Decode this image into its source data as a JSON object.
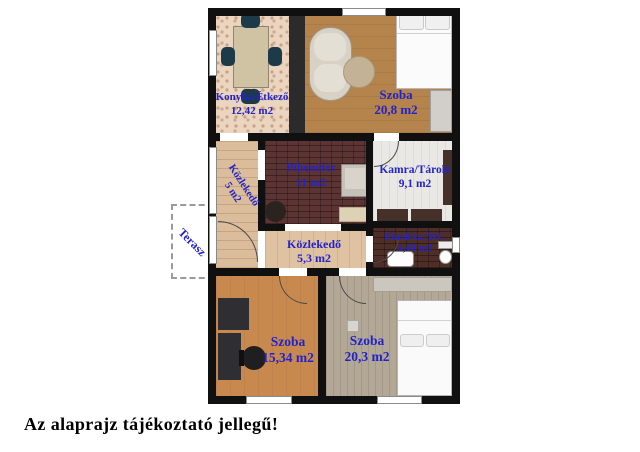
{
  "plan": {
    "rooms": [
      {
        "name": "Konyha/Étkező",
        "area": "12,42 m2"
      },
      {
        "name": "Szoba",
        "area": "20,8 m2"
      },
      {
        "name": "Közlekedő",
        "area": "5 m2"
      },
      {
        "name": "Pihenőtér",
        "area": "11 m2"
      },
      {
        "name": "Kamra/Tároló",
        "area": "9,1 m2"
      },
      {
        "name": "Közlekedő",
        "area": "5,3 m2"
      },
      {
        "name": "Fürdősz./WC",
        "area": "4,46 m2"
      },
      {
        "name": "Szoba",
        "area": "15,34 m2"
      },
      {
        "name": "Szoba",
        "area": "20,3 m2"
      }
    ],
    "terrace_label": "Terasz",
    "caption": "Az alaprajz tájékoztató jellegű!",
    "colors": {
      "label_blue": "#2323c8",
      "wall_black": "#101010",
      "kitchen_floor": "#e9d5c0",
      "bedroom_top_floor": "#b5834c",
      "hall_floor": "#dcbd9b",
      "lounge_floor": "#5d3434",
      "pantry_floor": "#eae8e4",
      "bath_floor": "#4f2e27",
      "bedroom_left_floor": "#c8894e",
      "bedroom_right_floor": "#b3a896"
    }
  }
}
